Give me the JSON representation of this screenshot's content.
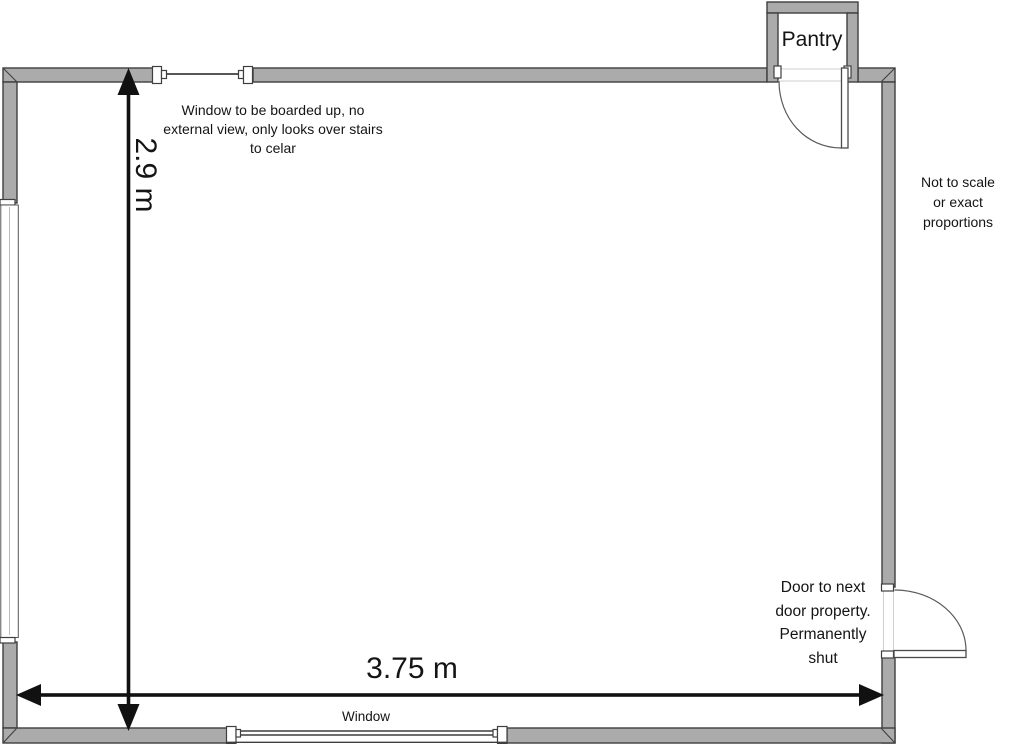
{
  "floor_plan": {
    "room_labels": {
      "pantry": "Pantry"
    },
    "dimensions": {
      "width": "3.75 m",
      "height": "2.9 m"
    },
    "annotations": {
      "boarded_window_lines": [
        "Window to be boarded up, no",
        "external view, only looks over stairs",
        "to celar"
      ],
      "scale_note_lines": [
        "Not to scale",
        "or exact",
        "proportions"
      ],
      "party_door_lines": [
        "Door to next",
        "door property.",
        "Permanently",
        "shut"
      ],
      "bottom_window": "Window"
    },
    "colors": {
      "wall_fill": "#ababab",
      "wall_outline": "#3f3f3f",
      "dimension_color": "#111111",
      "background": "#ffffff"
    }
  }
}
